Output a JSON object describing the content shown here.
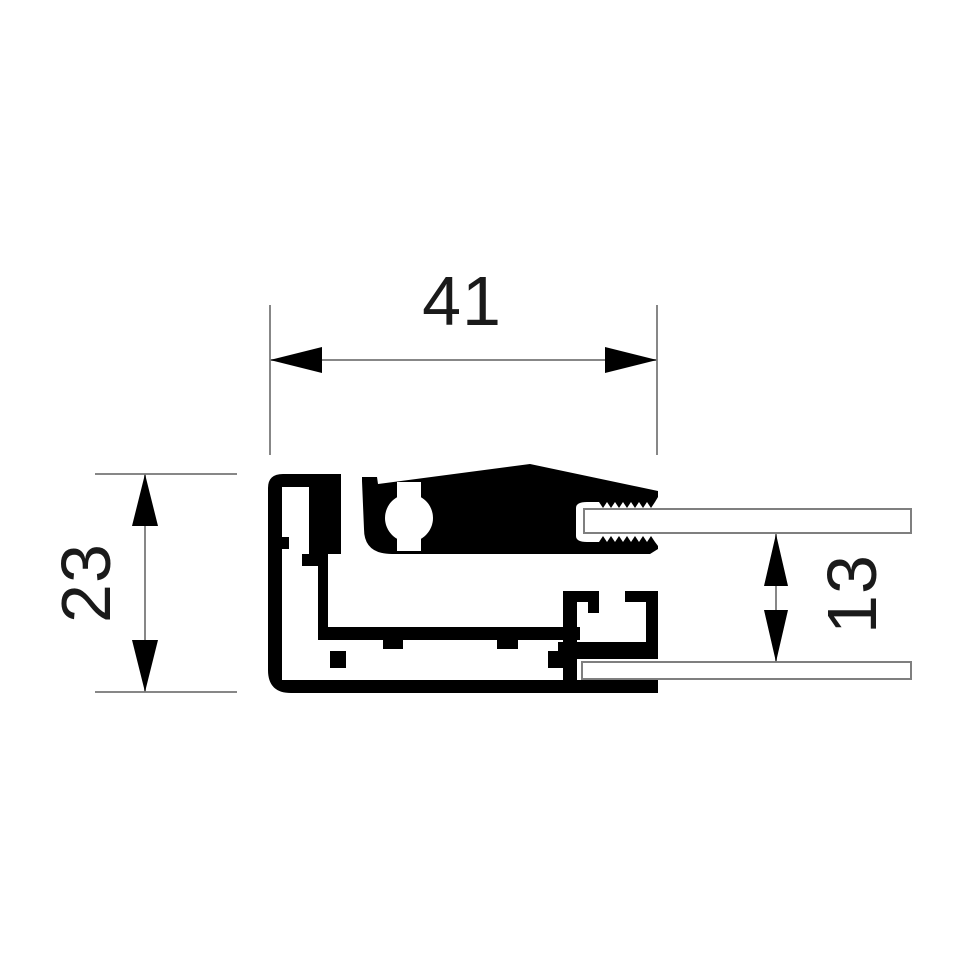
{
  "drawing": {
    "background_color": "#ffffff",
    "profile_color": "#000000",
    "dimension_line_color": "#878787",
    "arrow_color": "#000000",
    "text_color": "#1a1a1a",
    "glass_fill_color": "#ffffff",
    "glass_outline_color": "#7f7f7f",
    "dimensions": {
      "overall_width": {
        "label": "41"
      },
      "overall_height": {
        "label": "23"
      },
      "glass_spacing": {
        "label": "13"
      }
    }
  }
}
